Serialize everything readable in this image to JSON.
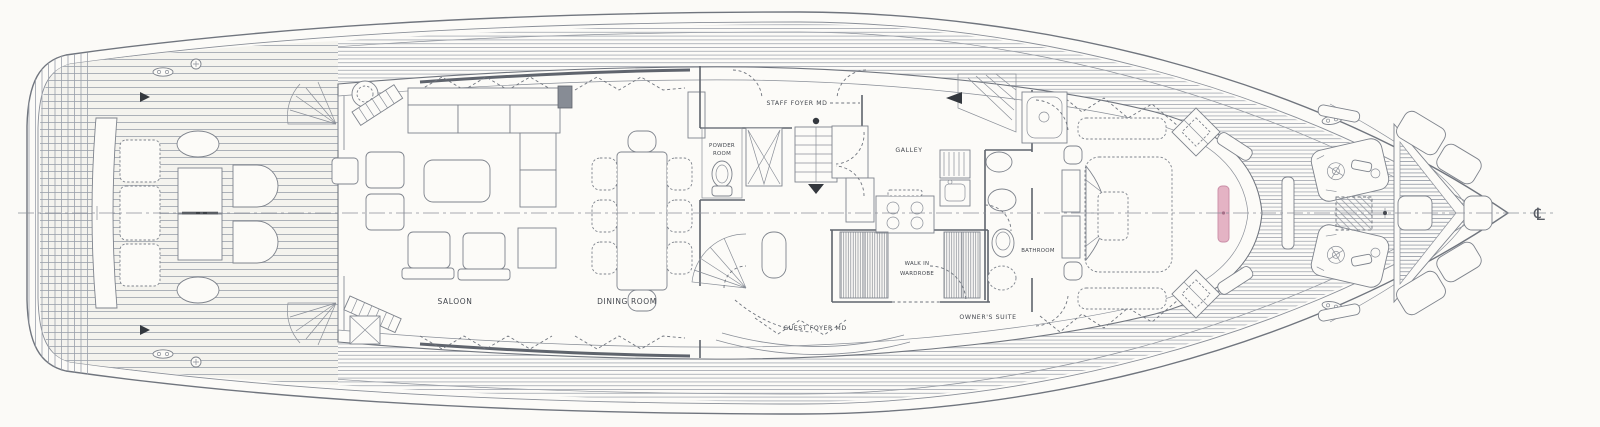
{
  "deck_plan": {
    "rooms": {
      "saloon": {
        "label": "SALOON"
      },
      "dining_room": {
        "label": "DINING ROOM"
      },
      "powder_room": {
        "label_line1": "POWDER",
        "label_line2": "ROOM"
      },
      "staff_foyer": {
        "label": "STAFF FOYER MD"
      },
      "galley": {
        "label": "GALLEY"
      },
      "walk_in_wardrobe": {
        "label_line1": "WALK IN",
        "label_line2": "WARDROBE"
      },
      "bathroom": {
        "label": "BATHROOM"
      },
      "guest_foyer": {
        "label": "GUEST FOYER MD"
      },
      "owners_suite": {
        "label": "OWNER'S SUITE"
      }
    },
    "annotations": {
      "centerline_symbol": "℄"
    },
    "colors": {
      "paper": "#fbfaf7",
      "ink": "#70757e",
      "ink_dark": "#43474e",
      "deck_hatch": "#a2a7b0",
      "tv_accent": "#e4b3c4"
    }
  }
}
